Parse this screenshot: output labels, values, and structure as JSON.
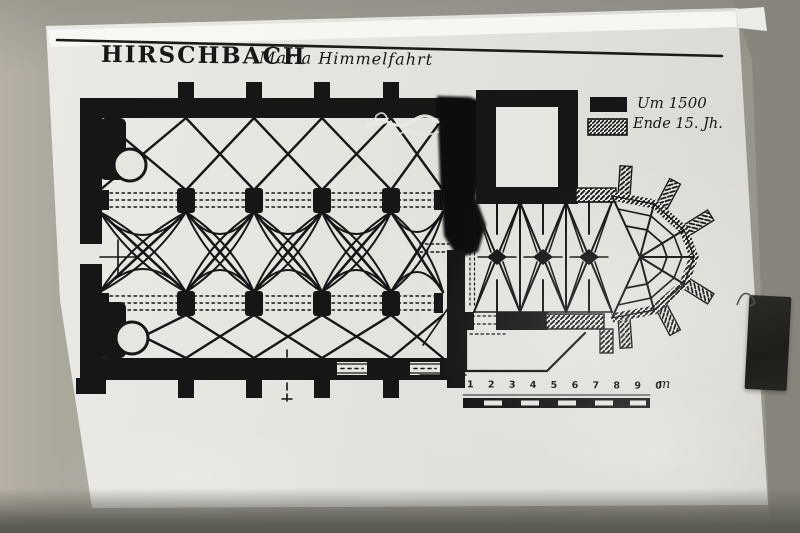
{
  "sign": {
    "title": "HIRSCHBACH",
    "subtitle": "Maria Himmelfahrt",
    "legend": {
      "item_solid": {
        "label": "Um 1500",
        "swatch": "solid-black-swatch"
      },
      "item_hatched": {
        "label": "Ende 15. Jh.",
        "swatch": "hatched-swatch"
      }
    },
    "scale": {
      "numbers": "1 2 3 4 5 6 7 8 9 0",
      "unit": "m"
    }
  },
  "colors": {
    "ink": "#171717",
    "paper": "#e6e5e0",
    "wall": "#a3a096",
    "tape": "#24231f",
    "shadow_band": "#5e5d56"
  }
}
